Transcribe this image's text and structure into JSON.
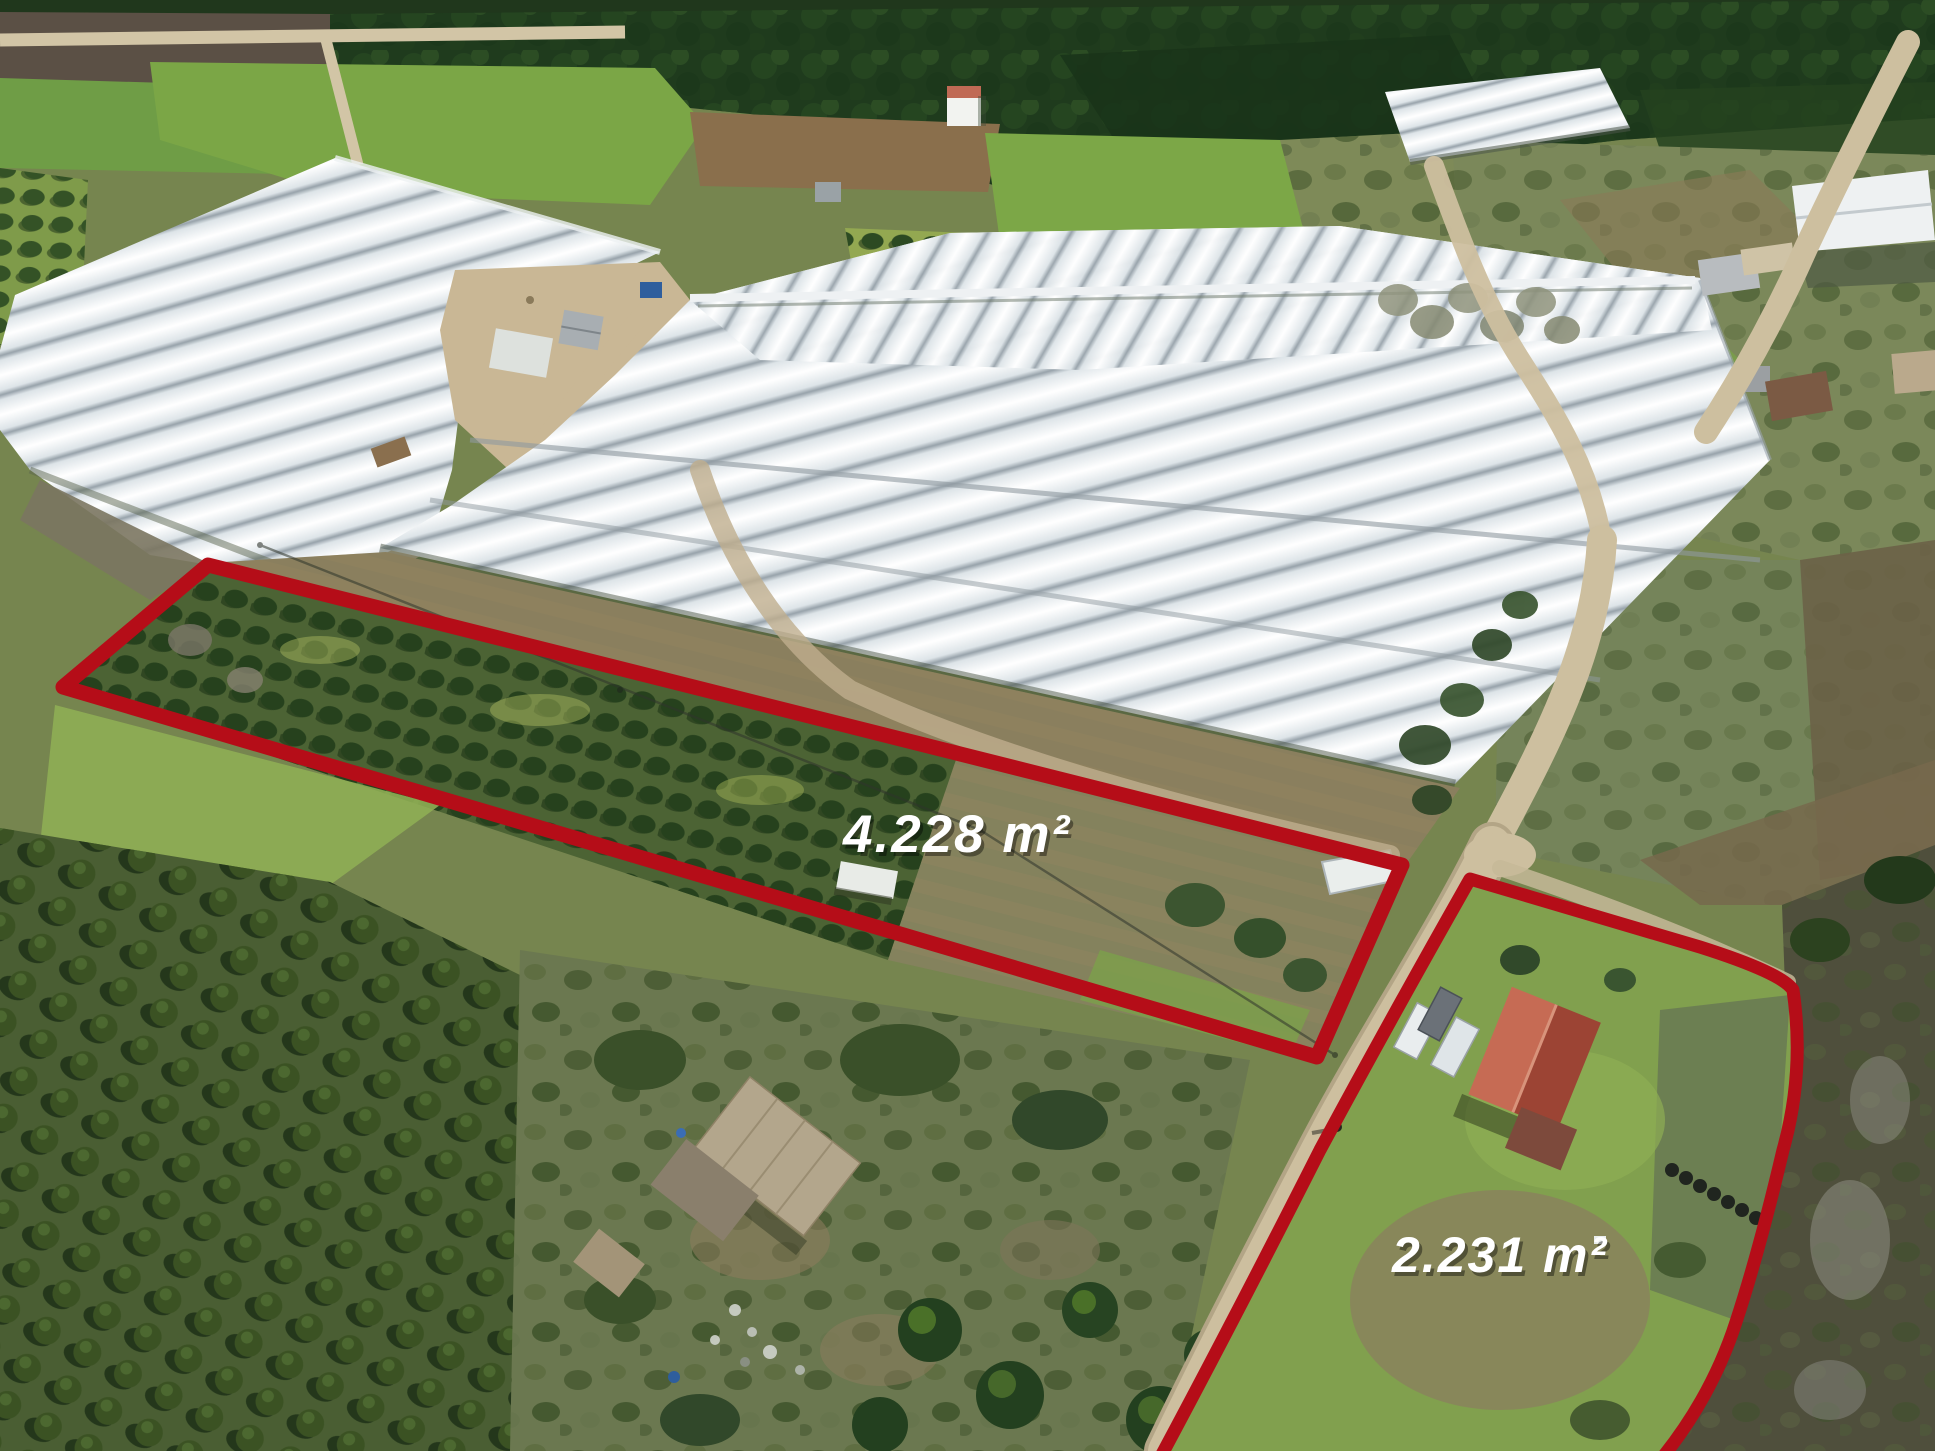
{
  "parcels": [
    {
      "name": "parcel-1",
      "area_label": "4.228 m²"
    },
    {
      "name": "parcel-2",
      "area_label": "2.231 m²"
    }
  ],
  "colors": {
    "outline_red": "#b50d18",
    "label_white": "#ffffff"
  }
}
